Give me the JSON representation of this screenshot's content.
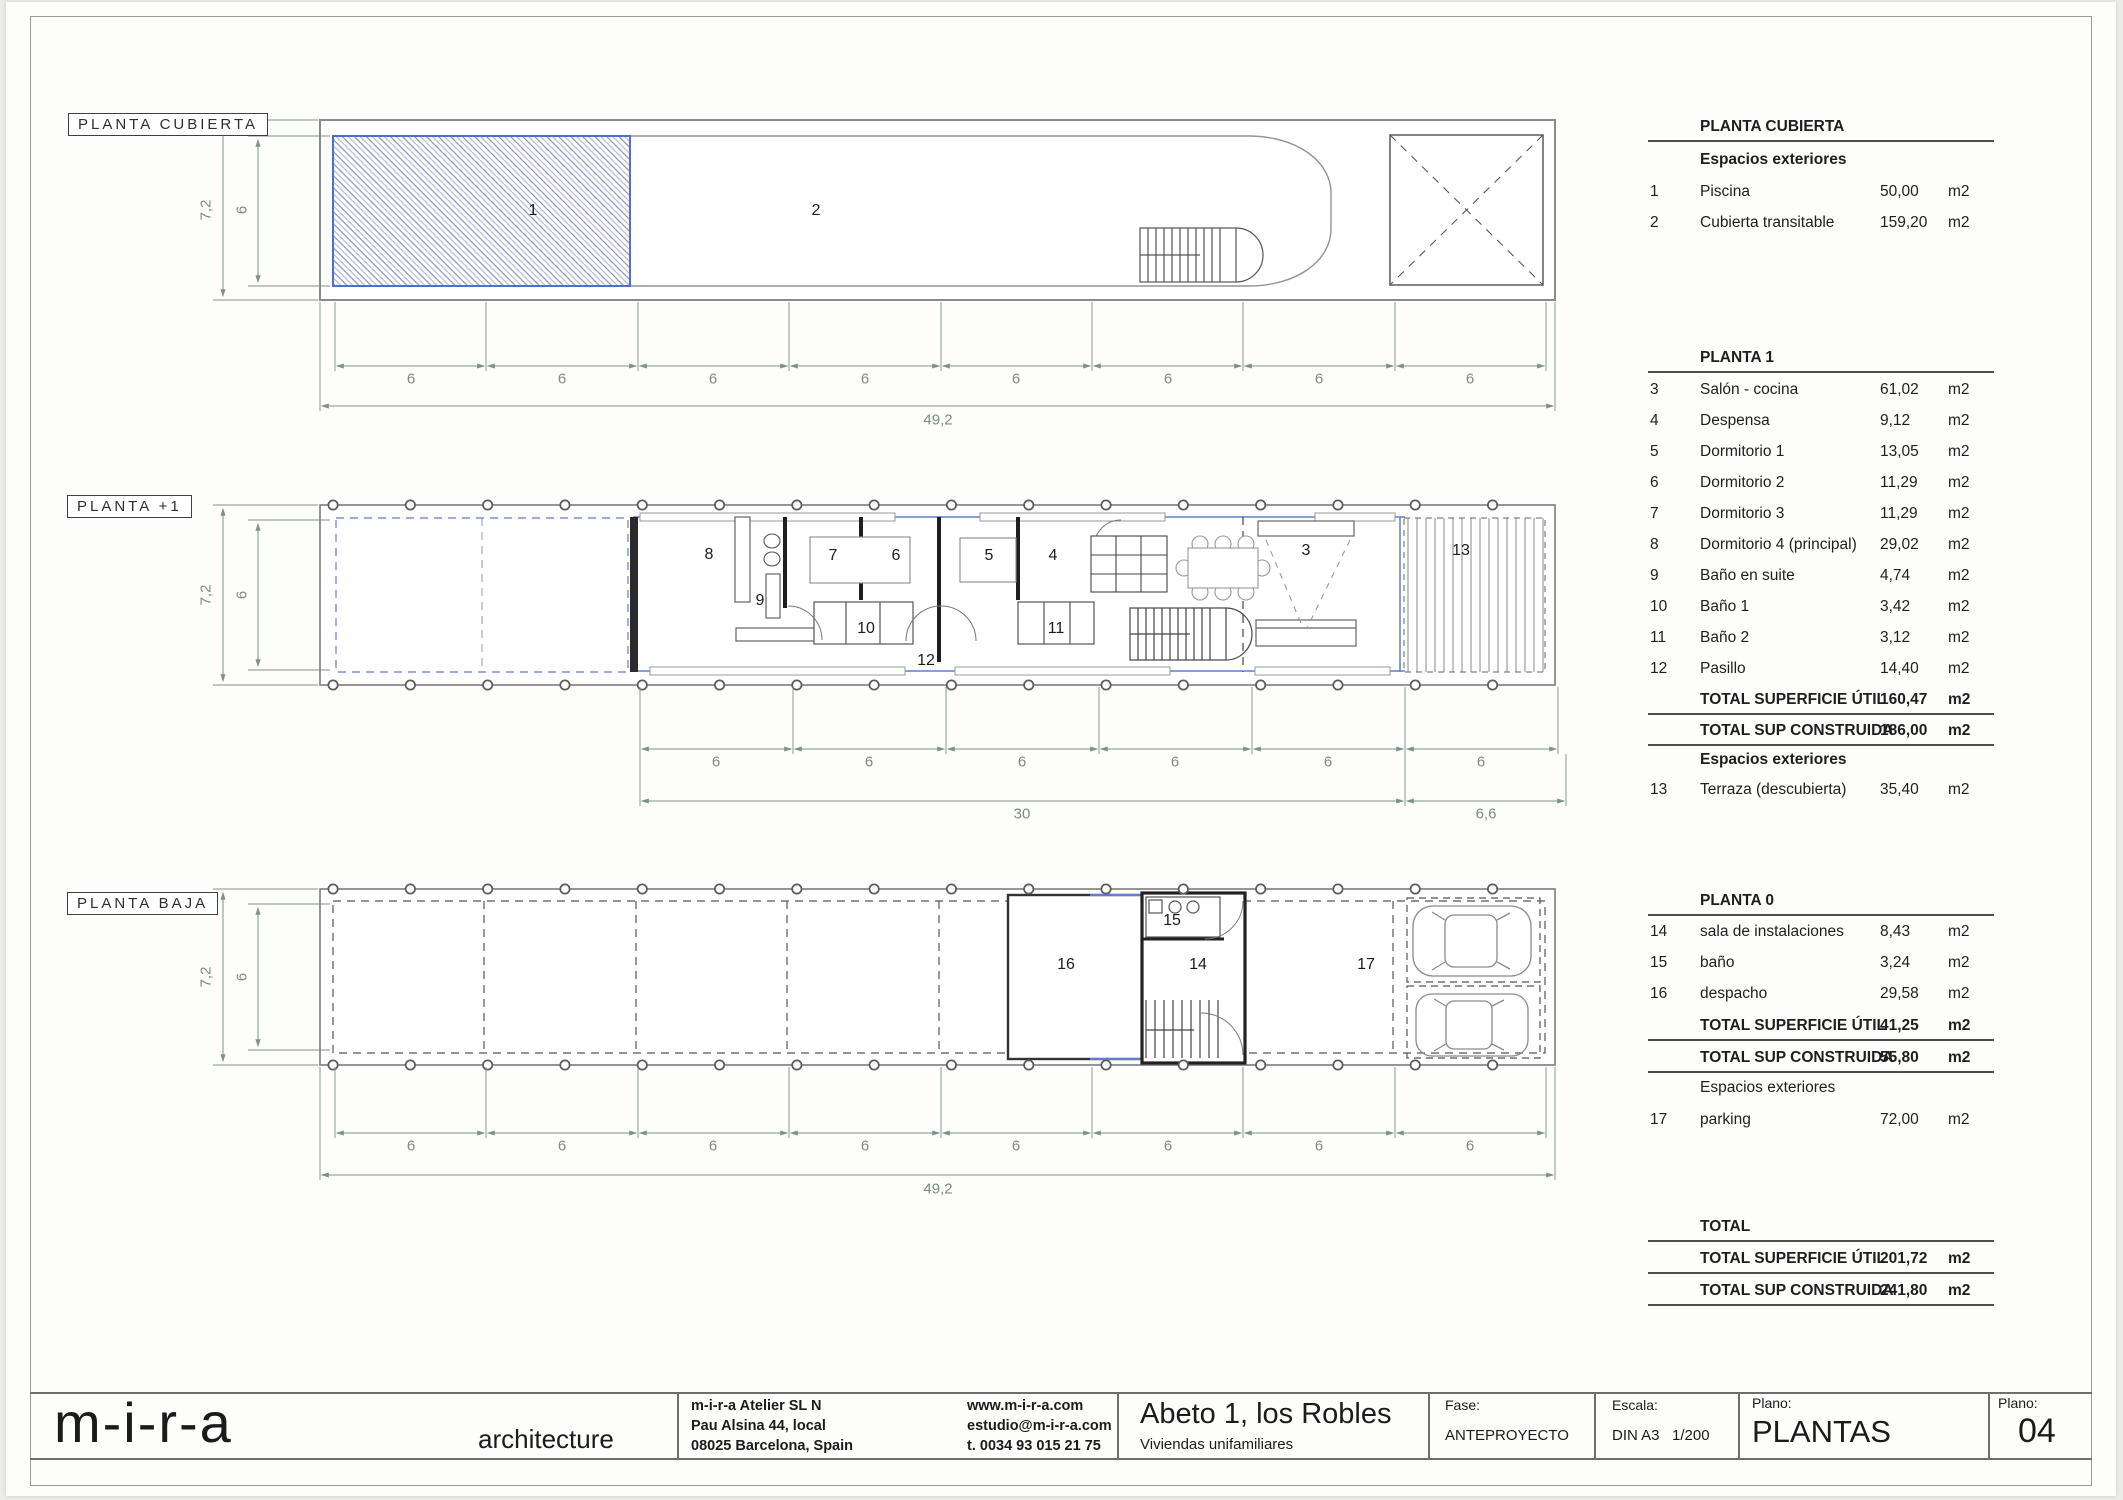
{
  "plans": {
    "cubierta": {
      "tag": "PLANTA CUBIERTA",
      "dim_outer": "7,2",
      "dim_inner": "6",
      "chain": [
        "6",
        "6",
        "6",
        "6",
        "6",
        "6",
        "6",
        "6"
      ],
      "total": "49,2",
      "rooms": {
        "pool": "1",
        "roof": "2"
      }
    },
    "p1": {
      "tag": "PLANTA +1",
      "dim_outer": "7,2",
      "dim_inner": "6",
      "chain": [
        "6",
        "6",
        "6",
        "6",
        "6",
        "6"
      ],
      "total_a": "30",
      "total_b": "6,6",
      "rooms": {
        "r8": "8",
        "r9": "9",
        "r7": "7",
        "r6": "6",
        "r10": "10",
        "r5": "5",
        "r4": "4",
        "r11": "11",
        "r12": "12",
        "r3": "3",
        "r13": "13"
      }
    },
    "baja": {
      "tag": "PLANTA BAJA",
      "dim_outer": "7,2",
      "dim_inner": "6",
      "chain": [
        "6",
        "6",
        "6",
        "6",
        "6",
        "6",
        "6",
        "6"
      ],
      "total": "49,2",
      "rooms": {
        "r16": "16",
        "r15": "15",
        "r14": "14",
        "r17": "17"
      }
    }
  },
  "tables": {
    "cubierta": {
      "title": "PLANTA CUBIERTA",
      "subtitle": "Espacios exteriores",
      "rows": [
        {
          "n": "1",
          "name": "Piscina",
          "val": "50,00",
          "unit": "m2"
        },
        {
          "n": "2",
          "name": "Cubierta transitable",
          "val": "159,20",
          "unit": "m2"
        }
      ]
    },
    "planta1": {
      "title": "PLANTA 1",
      "rows": [
        {
          "n": "3",
          "name": "Salón - cocina",
          "val": "61,02",
          "unit": "m2"
        },
        {
          "n": "4",
          "name": "Despensa",
          "val": "9,12",
          "unit": "m2"
        },
        {
          "n": "5",
          "name": "Dormitorio 1",
          "val": "13,05",
          "unit": "m2"
        },
        {
          "n": "6",
          "name": "Dormitorio 2",
          "val": "11,29",
          "unit": "m2"
        },
        {
          "n": "7",
          "name": "Dormitorio 3",
          "val": "11,29",
          "unit": "m2"
        },
        {
          "n": "8",
          "name": "Dormitorio 4 (principal)",
          "val": "29,02",
          "unit": "m2"
        },
        {
          "n": "9",
          "name": "Baño en suite",
          "val": "4,74",
          "unit": "m2"
        },
        {
          "n": "10",
          "name": "Baño 1",
          "val": "3,42",
          "unit": "m2"
        },
        {
          "n": "11",
          "name": "Baño 2",
          "val": "3,12",
          "unit": "m2"
        },
        {
          "n": "12",
          "name": "Pasillo",
          "val": "14,40",
          "unit": "m2"
        }
      ],
      "total_util": {
        "label": "TOTAL SUPERFICIE ÚTIL",
        "val": "160,47",
        "unit": "m2"
      },
      "total_const": {
        "label": "TOTAL SUP CONSTRUIDA",
        "val": "186,00",
        "unit": "m2"
      },
      "subtitle": "Espacios exteriores",
      "ext_rows": [
        {
          "n": "13",
          "name": "Terraza (descubierta)",
          "val": "35,40",
          "unit": "m2"
        }
      ]
    },
    "planta0": {
      "title": "PLANTA 0",
      "rows": [
        {
          "n": "14",
          "name": "sala de instalaciones",
          "val": "8,43",
          "unit": "m2"
        },
        {
          "n": "15",
          "name": "baño",
          "val": "3,24",
          "unit": "m2"
        },
        {
          "n": "16",
          "name": "despacho",
          "val": "29,58",
          "unit": "m2"
        }
      ],
      "total_util": {
        "label": "TOTAL SUPERFICIE ÚTIL",
        "val": "41,25",
        "unit": "m2"
      },
      "total_const": {
        "label": "TOTAL SUP CONSTRUIDA",
        "val": "55,80",
        "unit": "m2"
      },
      "subtitle": "Espacios exteriores",
      "ext_rows": [
        {
          "n": "17",
          "name": "parking",
          "val": "72,00",
          "unit": "m2"
        }
      ]
    },
    "total": {
      "title": "TOTAL",
      "rows": [
        {
          "label": "TOTAL SUPERFICIE ÚTIL",
          "val": "201,72",
          "unit": "m2"
        },
        {
          "label": "TOTAL SUP CONSTRUIDA",
          "val": "241,80",
          "unit": "m2"
        }
      ]
    }
  },
  "titleblock": {
    "logo": "m-i-r-a",
    "tagline": "architecture",
    "address": [
      "m-i-r-a Atelier SL N",
      "Pau Alsina 44, local",
      "08025 Barcelona, Spain"
    ],
    "contact": [
      "www.m-i-r-a.com",
      "estudio@m-i-r-a.com",
      "t. 0034 93 015 21 75"
    ],
    "project": "Abeto 1, los Robles",
    "project_sub": "Viviendas unifamiliares",
    "fase_label": "Fase:",
    "fase": "ANTEPROYECTO",
    "escala_label": "Escala:",
    "escala": "DIN A3   1/200",
    "plano_label": "Plano:",
    "plano": "PLANTAS",
    "num_label": "Plano:",
    "num": "04"
  },
  "colors": {
    "dim_green": "#7d9285",
    "plan_gray": "#888888",
    "accent_blue": "#5f7fd0",
    "wall_black": "#1f1f1f"
  }
}
